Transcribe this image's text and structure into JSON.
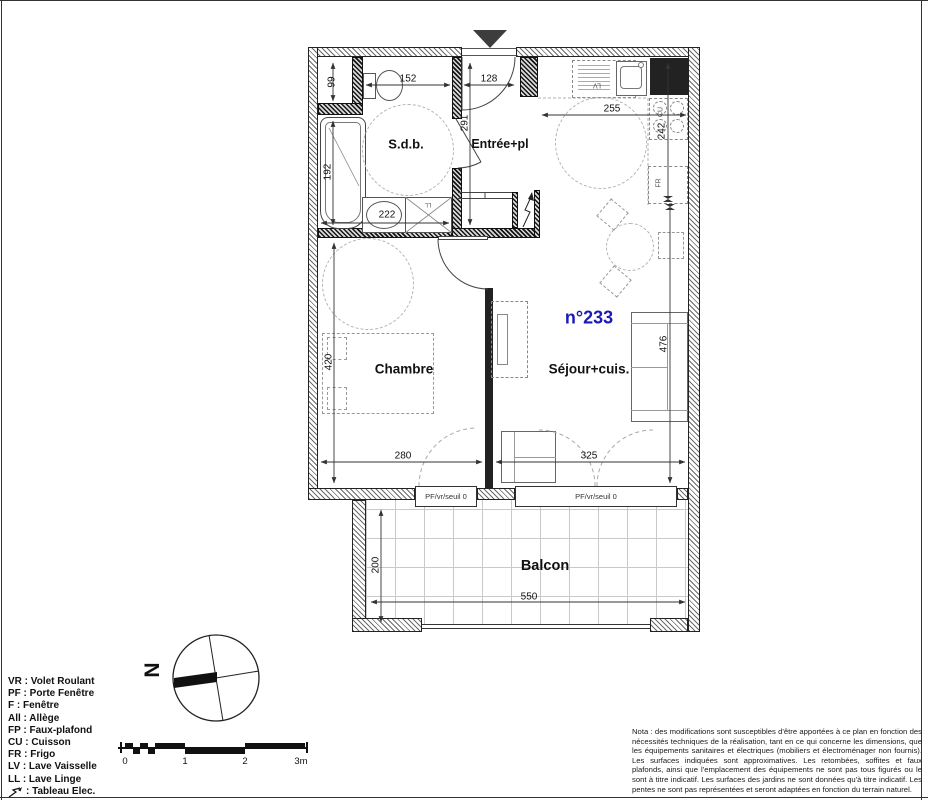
{
  "plan": {
    "unit_number": "n°233",
    "rooms": {
      "sdb": "S.d.b.",
      "entree": "Entrée+pl",
      "chambre": "Chambre",
      "sejour": "Séjour+cuis.",
      "balcon": "Balcon"
    },
    "dimensions_cm": {
      "niche": "99",
      "sdb_width": "152",
      "entree_width": "128",
      "entree_depth": "291",
      "cuisine_width": "255",
      "cuisine_depth": "242",
      "baignoire": "192",
      "sdb_lower_width": "222",
      "chambre_depth": "420",
      "sejour_depth": "476",
      "chambre_width": "280",
      "sejour_width": "325",
      "balcon_depth": "200",
      "balcon_width": "550"
    },
    "windows": {
      "window1": "PF/vr/seuil 0",
      "window2": "PF/vr/seuil 0"
    },
    "appliances": {
      "lave_vaisselle": "LV",
      "cuisson": "CU",
      "frigo": "FR",
      "lave_linge": "LL"
    },
    "colors": {
      "unit_number_blue": "#1a1ab4",
      "linework": "#222222",
      "wall_hatch": "#6a6a6a"
    }
  },
  "compass": {
    "north": "N"
  },
  "scalebar": {
    "labels": [
      "0",
      "1",
      "2",
      "3m"
    ]
  },
  "legend": {
    "items": [
      "VR : Volet Roulant",
      "PF : Porte Fenêtre",
      "F : Fenêtre",
      "All : Allège",
      "FP : Faux-plafond",
      "CU : Cuisson",
      "FR : Frigo",
      "LV : Lave Vaisselle",
      "LL : Lave Linge"
    ],
    "tableau_elec": ": Tableau Elec."
  },
  "nota": "Nota : des modifications sont susceptibles d'être apportées à ce plan en fonction des nécessités techniques de la réalisation, tant en ce qui concerne les dimensions, que les équipements sanitaires et électriques (mobiliers et électroménager non fournis). Les surfaces indiquées sont approximatives. Les retombées, soffites et faux plafonds, ainsi que l'emplacement des équipements ne sont pas tous figurés ou le sont à titre indicatif. Les surfaces des jardins ne sont données qu'à titre indicatif. Les pentes ne sont pas représentées et seront adaptées en fonction du terrain naturel."
}
